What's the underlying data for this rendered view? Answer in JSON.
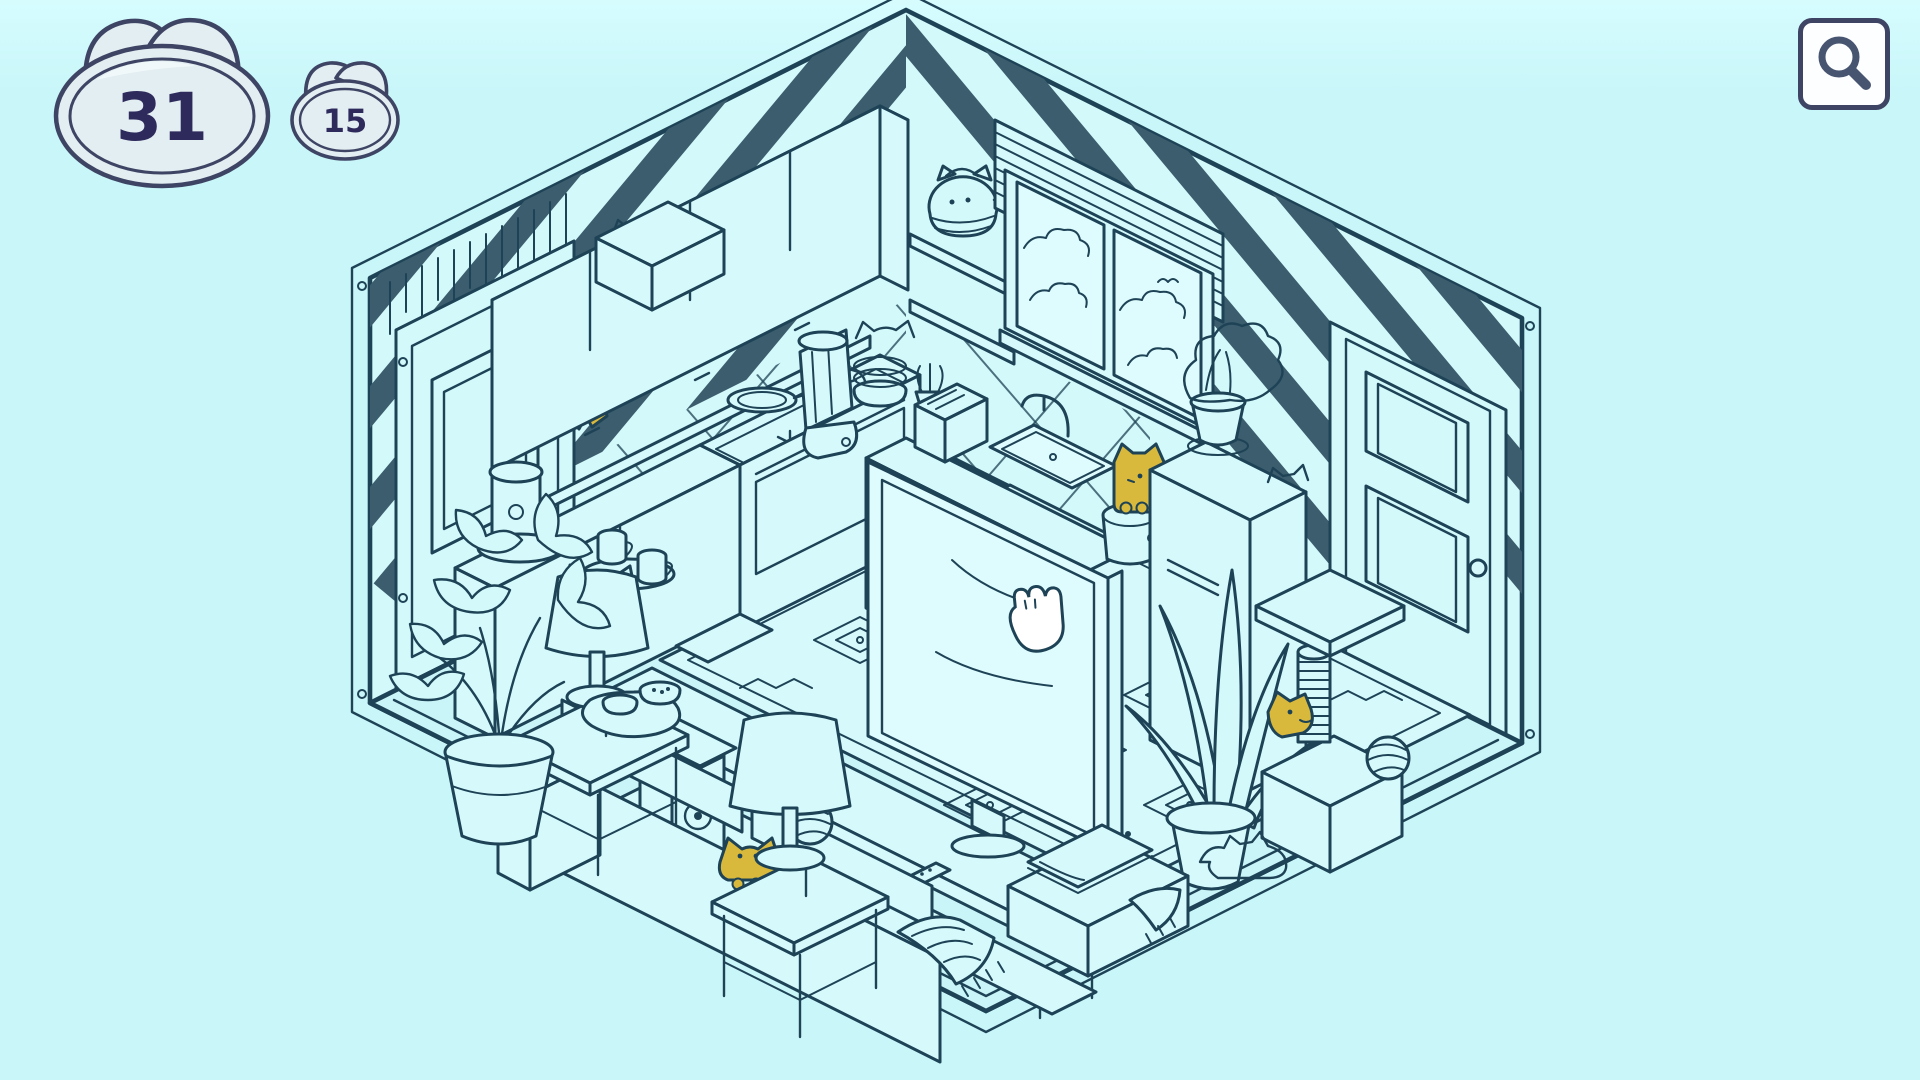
{
  "hud": {
    "primary_counter": {
      "value": "31"
    },
    "secondary_counter": {
      "value": "15"
    },
    "zoom_button": {
      "icon": "magnifier-icon"
    }
  },
  "colors": {
    "background": "#c8f6f9",
    "background_top": "#d6fcfe",
    "line": "#1e4356",
    "wallpaper_stripe": "#3c5d6d",
    "hidden_cat_yellow": "#d9b93c",
    "wall_fill": "#d3f9fb",
    "floor_fill": "#c9f5f8",
    "pane_fill": "#defcfe",
    "item_fill": "#d6fafc",
    "counter_fill": "#e3eef2",
    "counter_outline": "#3e4464",
    "counter_text": "#2e2a5c",
    "button_background": "#fdfeff"
  },
  "scene": {
    "style": "isometric line-art living room and kitchen, hidden-cats game",
    "cursor": "paw-cursor",
    "hidden_cats": [
      {
        "id": "cat-on-wall-ledge"
      },
      {
        "id": "cat-by-sink"
      },
      {
        "id": "cat-behind-sofa"
      },
      {
        "id": "cat-at-scratching-post"
      }
    ],
    "outline_cats": [
      "cat-teapot-on-shelf",
      "cat-outline-wallpaper",
      "cat-outline-behind-blender",
      "cat-outline-behind-fridge",
      "cat-outline-by-cat-tree"
    ],
    "objects": [
      "striped wallpaper",
      "left door",
      "panel above door",
      "upper cabinets",
      "box on cabinets",
      "wall shelf",
      "window",
      "clouds",
      "blinds",
      "right door",
      "backsplash tiles",
      "kitchen floor tiles",
      "counter",
      "coffee maker",
      "mugs",
      "tray",
      "stove",
      "frying pan",
      "oven",
      "blender",
      "bowl stack",
      "small plants",
      "toaster",
      "sink",
      "faucet",
      "trash bin",
      "fridge",
      "plant on fridge",
      "tv",
      "tv stand",
      "media console",
      "remote control",
      "router",
      "speaker",
      "sofa",
      "cushions",
      "blanket",
      "rug",
      "side table",
      "table lamp",
      "cat-ear lamp",
      "pet bowls",
      "potted plant",
      "snake plant",
      "cat tower",
      "scratching post",
      "yarn balls",
      "books",
      "storage box"
    ]
  }
}
